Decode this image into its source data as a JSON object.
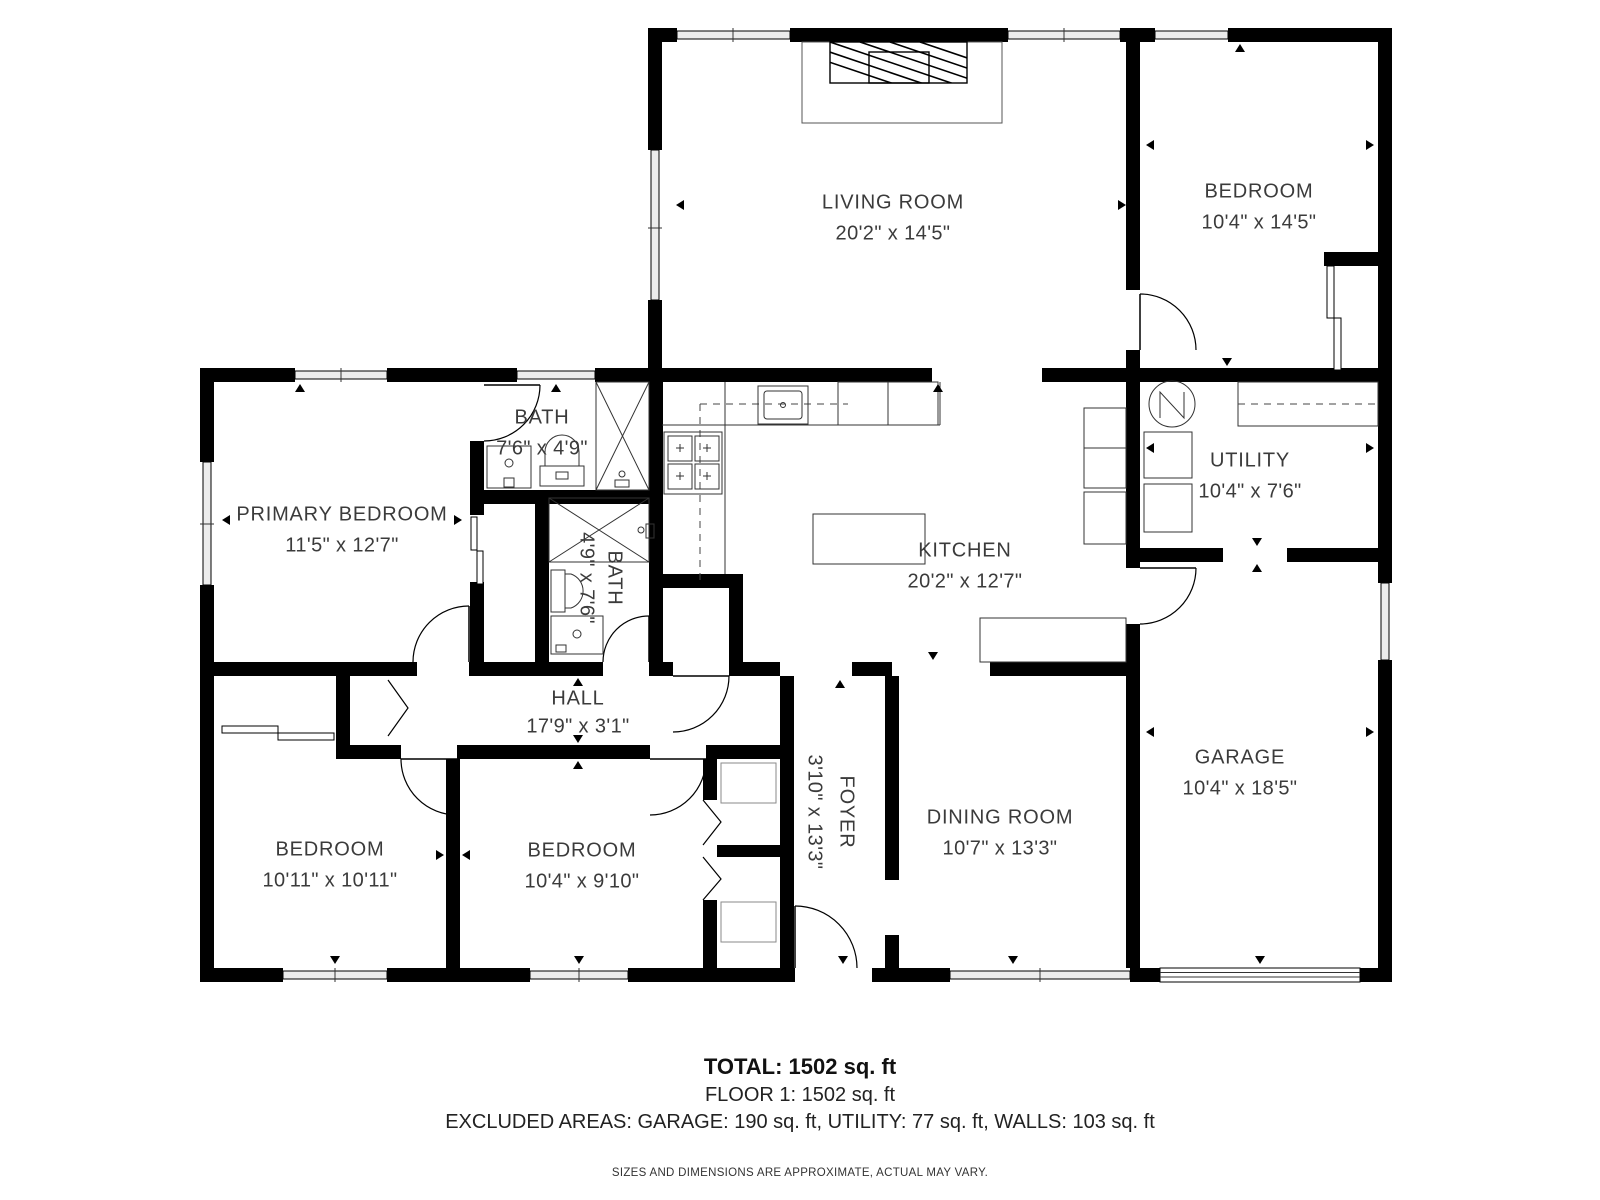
{
  "rooms": [
    {
      "name": "LIVING ROOM",
      "dims": "20'2\" x 14'5\""
    },
    {
      "name": "BEDROOM",
      "dims": "10'4\" x 14'5\""
    },
    {
      "name": "BATH",
      "dims": "7'6\" x 4'9\""
    },
    {
      "name": "PRIMARY BEDROOM",
      "dims": "11'5\" x 12'7\""
    },
    {
      "name": "BATH",
      "dims": "4'9\" x 7'6\""
    },
    {
      "name": "KITCHEN",
      "dims": "20'2\" x 12'7\""
    },
    {
      "name": "UTILITY",
      "dims": "10'4\" x 7'6\""
    },
    {
      "name": "HALL",
      "dims": "17'9\" x 3'1\""
    },
    {
      "name": "FOYER",
      "dims": "3'10\" x 13'3\""
    },
    {
      "name": "DINING ROOM",
      "dims": "10'7\" x 13'3\""
    },
    {
      "name": "GARAGE",
      "dims": "10'4\" x 18'5\""
    },
    {
      "name": "BEDROOM",
      "dims": "10'11\" x 10'11\""
    },
    {
      "name": "BEDROOM",
      "dims": "10'4\" x 9'10\""
    }
  ],
  "footer": {
    "total": "TOTAL: 1502 sq. ft",
    "floor": "FLOOR 1: 1502 sq. ft",
    "excluded": "EXCLUDED AREAS: GARAGE: 190 sq. ft, UTILITY: 77 sq. ft, WALLS: 103 sq. ft",
    "disclaimer": "SIZES AND DIMENSIONS ARE APPROXIMATE, ACTUAL MAY VARY."
  },
  "colors": {
    "wall": "#000000",
    "label": "#3b3b3b",
    "window_fill": "#ececec"
  }
}
